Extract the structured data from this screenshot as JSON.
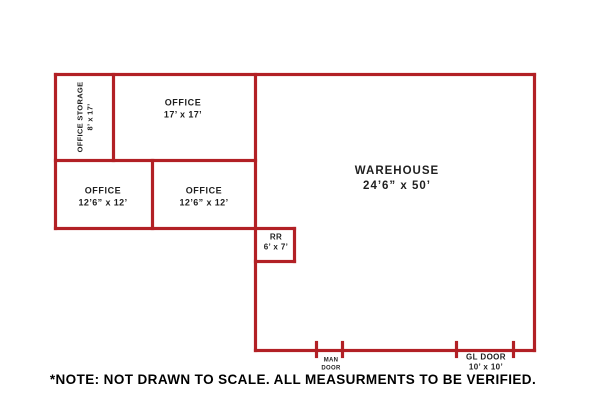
{
  "plan": {
    "rooms": [
      {
        "name": "office-storage",
        "label": "OFFICE STORAGE",
        "dims": "8’ x 17’"
      },
      {
        "name": "office-large",
        "label": "OFFICE",
        "dims": "17’ x 17’"
      },
      {
        "name": "office-left",
        "label": "OFFICE",
        "dims": "12’6” x 12’"
      },
      {
        "name": "office-right",
        "label": "OFFICE",
        "dims": "12’6” x 12’"
      },
      {
        "name": "restroom",
        "label": "RR",
        "dims": "6’ x 7’"
      },
      {
        "name": "warehouse",
        "label": "WAREHOUSE",
        "dims": "24’6” x 50’"
      }
    ],
    "doors": [
      {
        "name": "man-door",
        "line1": "MAN",
        "line2": "DOOR"
      },
      {
        "name": "gl-door",
        "line1": "GL DOOR",
        "line2": "10’ x 10’"
      }
    ],
    "note": "*NOTE: NOT DRAWN TO SCALE.  ALL MEASURMENTS TO BE VERIFIED.",
    "colors": {
      "wall": "#b22025",
      "text": "#1a1a1a"
    }
  }
}
